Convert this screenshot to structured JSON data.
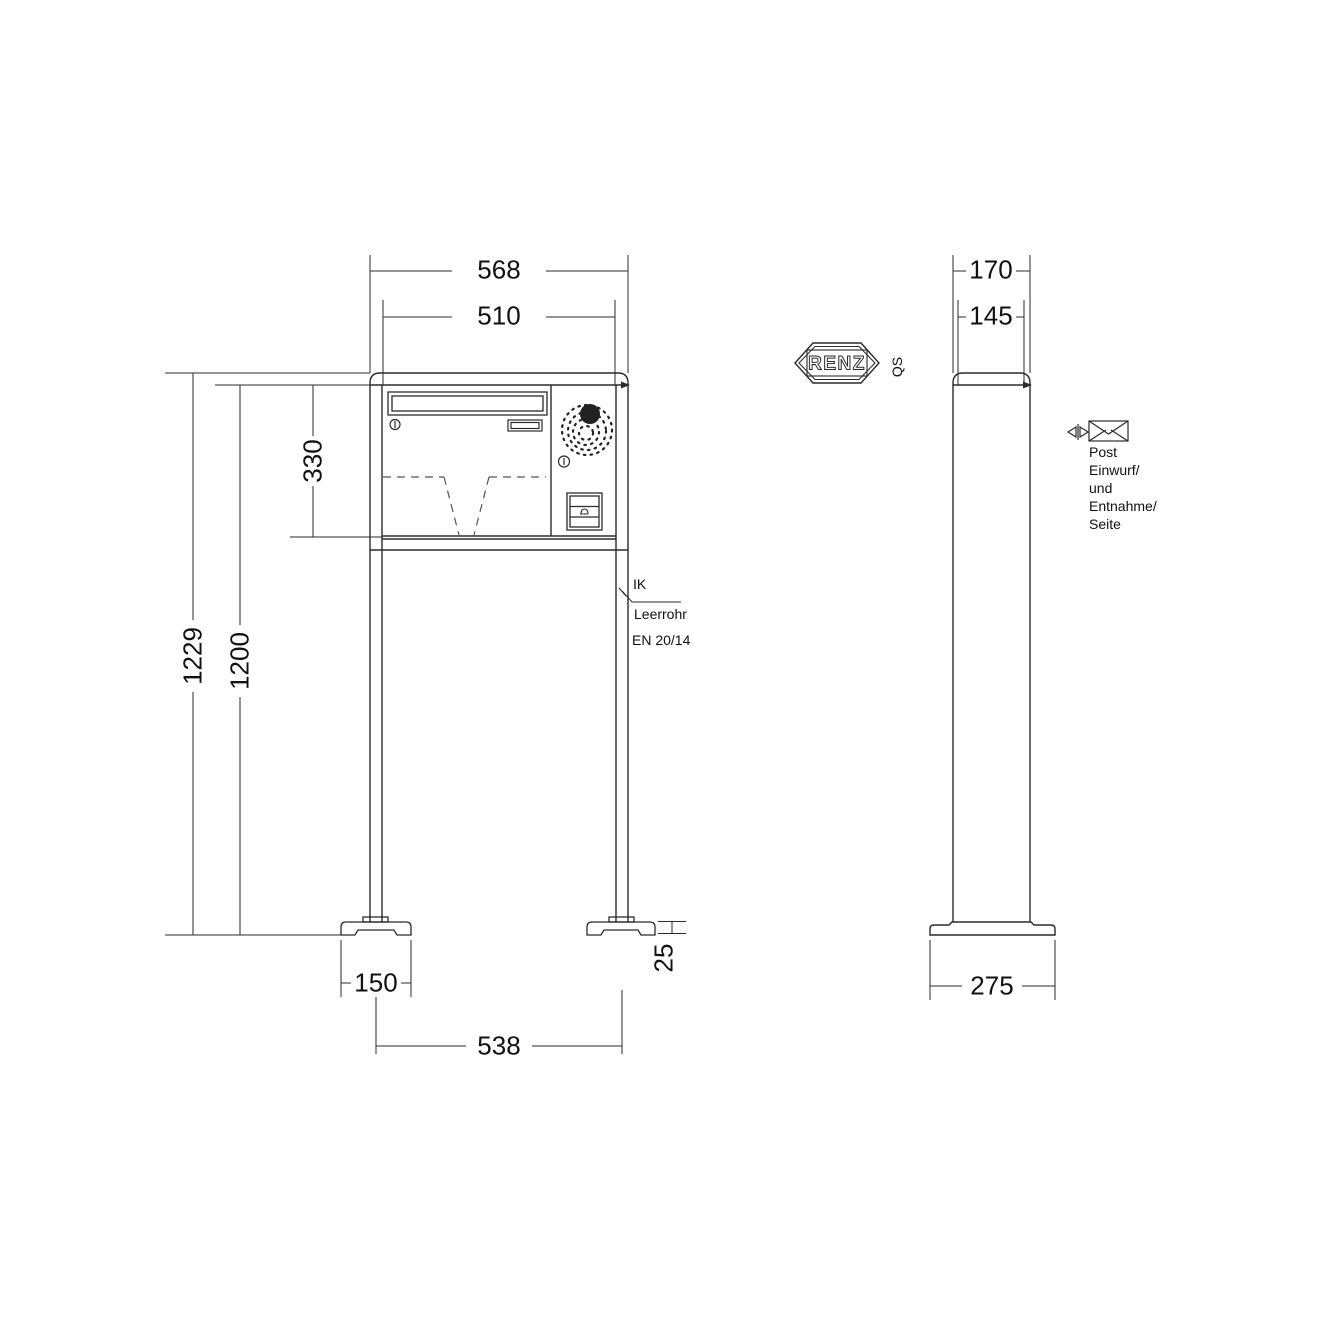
{
  "brand": {
    "logo_text": "RENZ",
    "logo_suffix": "QS"
  },
  "front_view": {
    "dims": {
      "width_outer": "568",
      "width_inner": "510",
      "box_height": "330",
      "height_total": "1229",
      "height_post": "1200",
      "base_width": "150",
      "base_spacing": "538",
      "base_height": "25"
    },
    "callout": {
      "line1": "IK",
      "line2": "Leerrohr",
      "line3": "EN 20/14"
    }
  },
  "side_view": {
    "dims": {
      "depth_outer": "170",
      "depth_inner": "145",
      "base_depth": "275"
    },
    "note": {
      "line1": "Post",
      "line2": "Einwurf/",
      "line3": "und",
      "line4": "Entnahme/",
      "line5": "Seite"
    }
  },
  "colors": {
    "line": "#2b2b2b",
    "text": "#111111",
    "background": "#ffffff"
  }
}
